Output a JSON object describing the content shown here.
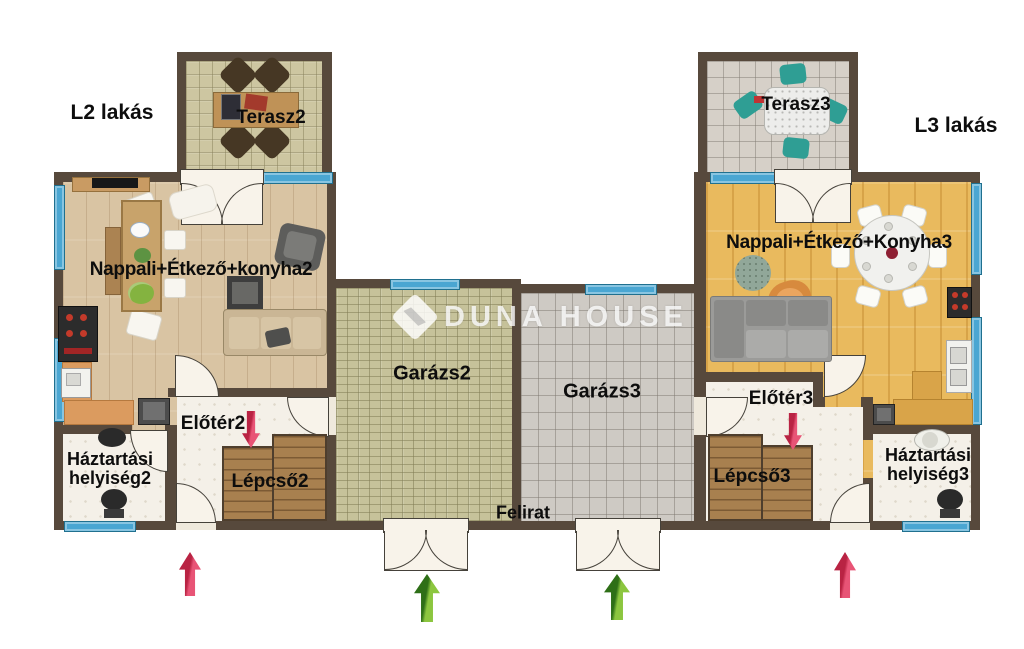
{
  "labels": {
    "l2_lakas": "L2 lakás",
    "l3_lakas": "L3 lakás",
    "terasz2": "Terasz2",
    "terasz3": "Terasz3",
    "nappali2": "Nappali+Étkező+konyha2",
    "nappali3": "Nappali+Étkező+Konyha3",
    "garazs2": "Garázs2",
    "garazs3": "Garázs3",
    "eloter2": "Előtér2",
    "eloter3": "Előtér3",
    "lepcso2": "Lépcső2",
    "lepcso3": "Lépcső3",
    "haztartasi2": "Háztartási helyiség2",
    "haztartasi3": "Háztartási helyiség3",
    "felirat": "Felirat"
  },
  "watermark": {
    "text": "DUNA HOUSE"
  },
  "colors": {
    "wall": "#57493c",
    "window_blue": "#4aa6d2",
    "door_fill": "#f8f3ea",
    "floor_wood_l2": "#d9c4a3",
    "floor_wood_l3": "#e9ba5e",
    "floor_terrace2": "#cdc6a1",
    "floor_terrace3": "#d6d0c8",
    "floor_garage2": "#c6c29a",
    "floor_garage3": "#cecac4",
    "floor_white": "#f4f0e8",
    "stairs_wood": "#a8804f",
    "arrow_red": "#cf2950",
    "arrow_green": "#5aa82d",
    "label_color": "#0d0d0d"
  }
}
